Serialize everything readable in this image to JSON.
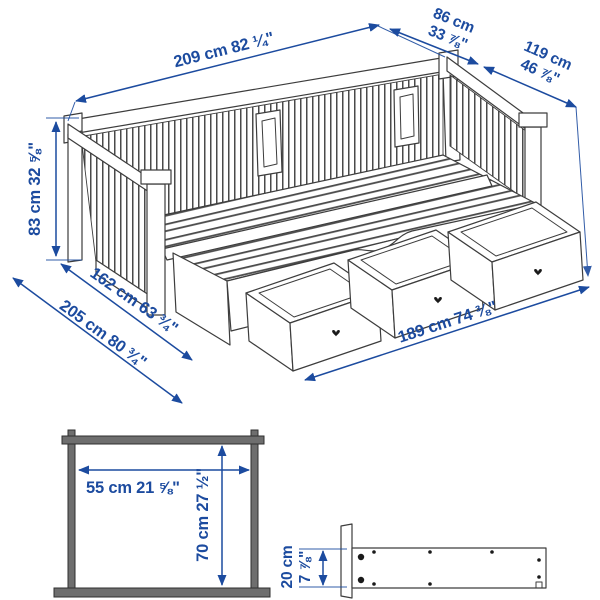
{
  "colors": {
    "accent": "#1c4b9f",
    "line": "#3d3d3d",
    "frame_gray": "#6e6e6e"
  },
  "main_view": {
    "name": "daybed extended isometric view",
    "dims": {
      "length": "209 cm 82 ¼\"",
      "width_a": "86 cm",
      "width_b": "33 ⅞\"",
      "ext_width_a": "119 cm",
      "ext_width_b": "46 ⅞\"",
      "height": "83 cm 32 ⅝\"",
      "depth_inner": "162 cm 63 ¾\"",
      "depth_outer": "205 cm 80 ¾\"",
      "drawer_front": "189 cm 74 ⅜\""
    }
  },
  "clearance_view": {
    "width": "55 cm 21 ⅝\"",
    "height": "70 cm 27 ½\""
  },
  "drawer_profile_view": {
    "height_a": "20 cm",
    "height_b": "7 ⅞\""
  }
}
